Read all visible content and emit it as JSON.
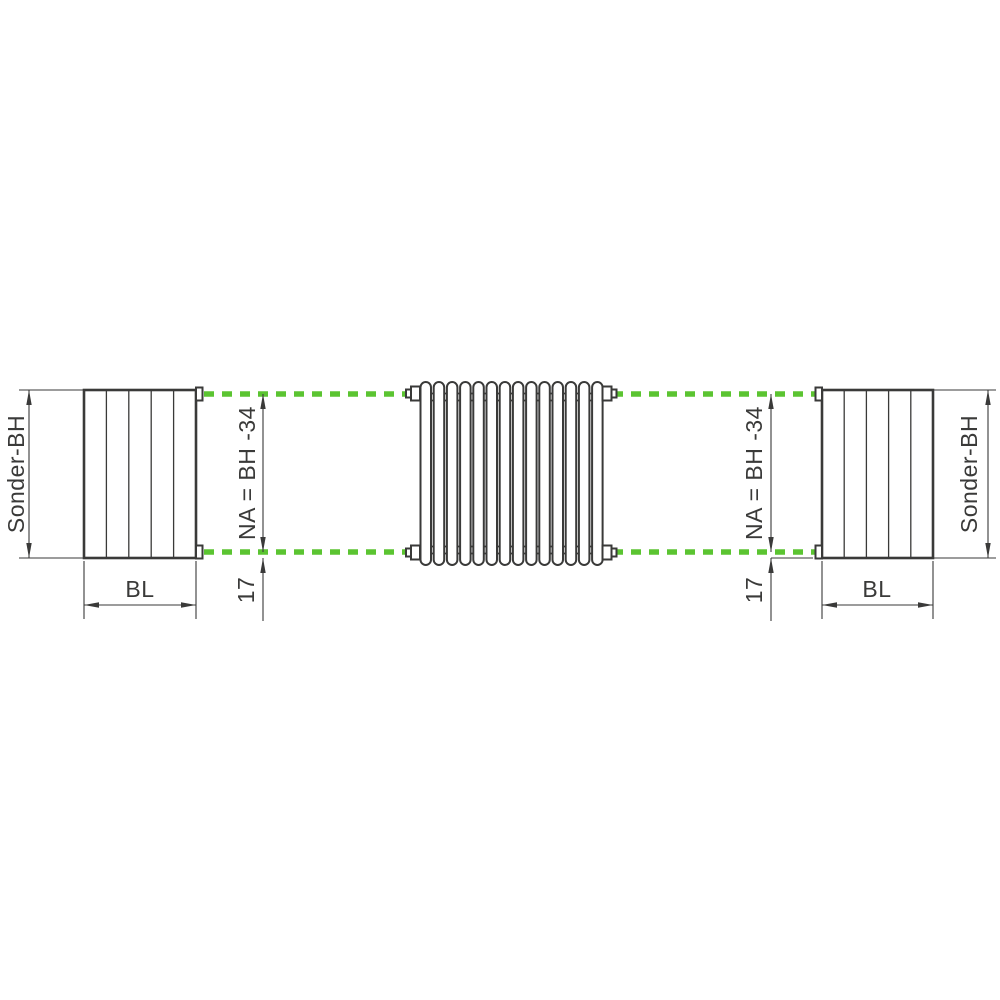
{
  "colors": {
    "accent_green": "#5BC431",
    "line_dark": "#3A3A39",
    "background": "#FFFFFF"
  },
  "dimensions": {
    "sonder_bh_left": "Sonder-BH",
    "sonder_bh_right": "Sonder-BH",
    "bl_left": "BL",
    "bl_right": "BL",
    "na_left": "NA = BH -34",
    "na_right": "NA = BH -34",
    "offset17_left": "17",
    "offset17_right": "17"
  }
}
